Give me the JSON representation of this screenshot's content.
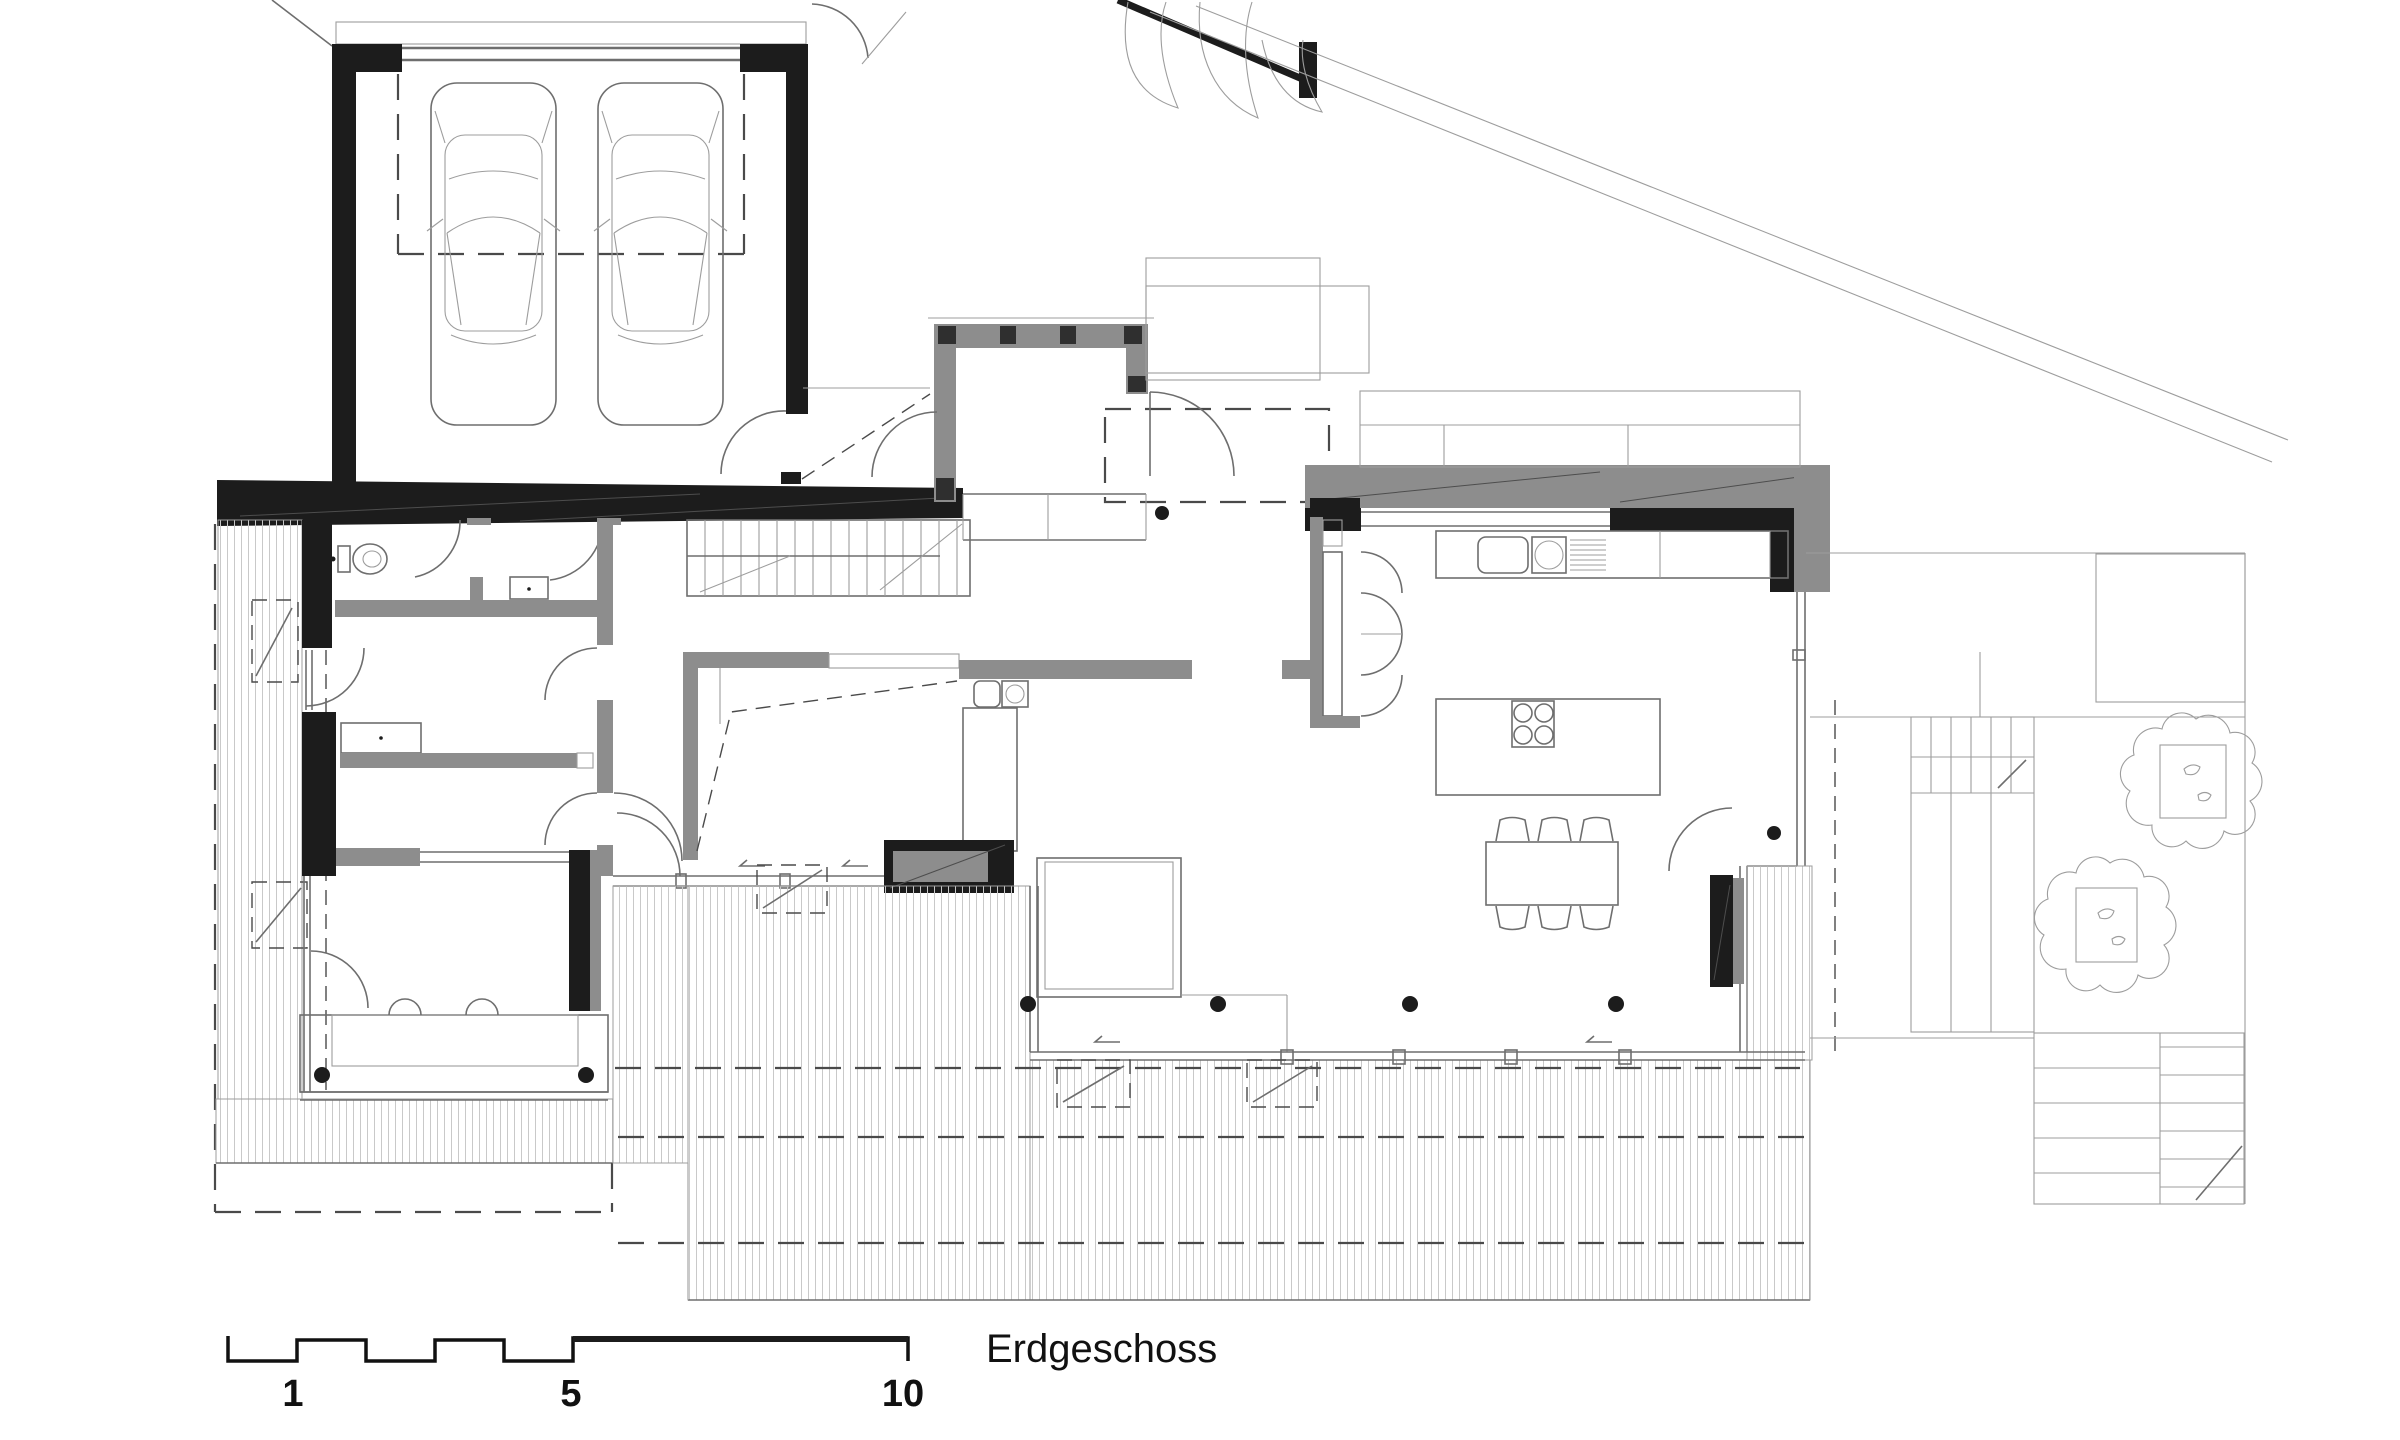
{
  "document": {
    "title": "Erdgeschoss",
    "drawing_type": "architectural ground floor plan"
  },
  "scale_bar": {
    "labels": [
      "1",
      "5",
      "10"
    ]
  },
  "colors": {
    "bg": "#ffffff",
    "wall-black": "#1c1c1c",
    "wall-dark": "#2f2f2f",
    "wall-gray": "#8d8d8d",
    "wall-light": "#b9b9b9",
    "line": "#6e6e6e",
    "line-light": "#9d9d9d",
    "hatch": "#c9c9c9",
    "dash": "#4a4a4a",
    "text": "#111111"
  },
  "symbols": {
    "car_icons_in_garage": 2,
    "toilet_icon": 1,
    "washbasin_icon": 1,
    "kitchen_sink_icon": 2,
    "cooktop_burners": 4,
    "dining_chairs": 6,
    "tree_icons": 2,
    "staircases": 3,
    "round_columns": 8,
    "door_swings": 12,
    "deck_hatch_areas": 6
  }
}
